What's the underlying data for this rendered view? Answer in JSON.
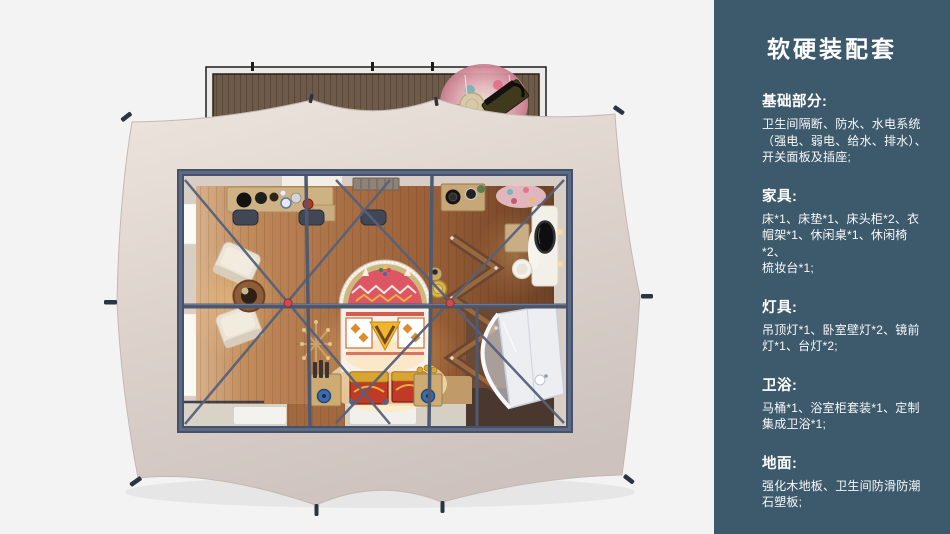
{
  "sidebar": {
    "title": "软硬装配套",
    "sections": [
      {
        "heading": "基础部分:",
        "body": "卫生间隔断、防水、水电系统\n（强电、弱电、给水、排水）、\n开关面板及插座;"
      },
      {
        "heading": "家具:",
        "body": "床*1、床垫*1、床头柜*2、衣\n帽架*1、休闲桌*1、休闲椅*2、\n梳妆台*1;"
      },
      {
        "heading": "灯具:",
        "body": "吊顶灯*1、卧室壁灯*2、镜前\n灯*1、台灯*2;"
      },
      {
        "heading": "卫浴:",
        "body": "马桶*1、浴室柜套装*1、定制\n集成卫浴*1;"
      },
      {
        "heading": "地面:",
        "body": "强化木地板、卫生间防滑防潮\n石塑板;"
      }
    ]
  },
  "colors": {
    "page_bg": "#f2f3f2",
    "sidebar_bg": "#3d5a6c",
    "sidebar_text": "#ffffff",
    "tent_canvas": "#e4dad4",
    "deck_wood": "#6e5a49",
    "floor_wood": "#a06640",
    "steel_frame": "#4e5a70",
    "joint_red": "#cf4a52",
    "bed_red": "#dc5663",
    "chest_red": "#c13a28",
    "gold": "#d9a531",
    "bathroom_white": "#eceef2"
  },
  "floorplan": {
    "elements": [
      "wood-deck",
      "deck-rug",
      "deck-bench",
      "tent-canvas",
      "tent-stakes",
      "room-frame",
      "desk",
      "desk-chairs",
      "lounge-chairs",
      "round-table",
      "bed",
      "bed-headboard",
      "storage-chests",
      "coat-rack",
      "bedside-tables",
      "zigzag-shelf",
      "dressing-table",
      "mirror",
      "stool",
      "stove-counter",
      "bathroom-unit",
      "windows",
      "floor-mats"
    ]
  }
}
